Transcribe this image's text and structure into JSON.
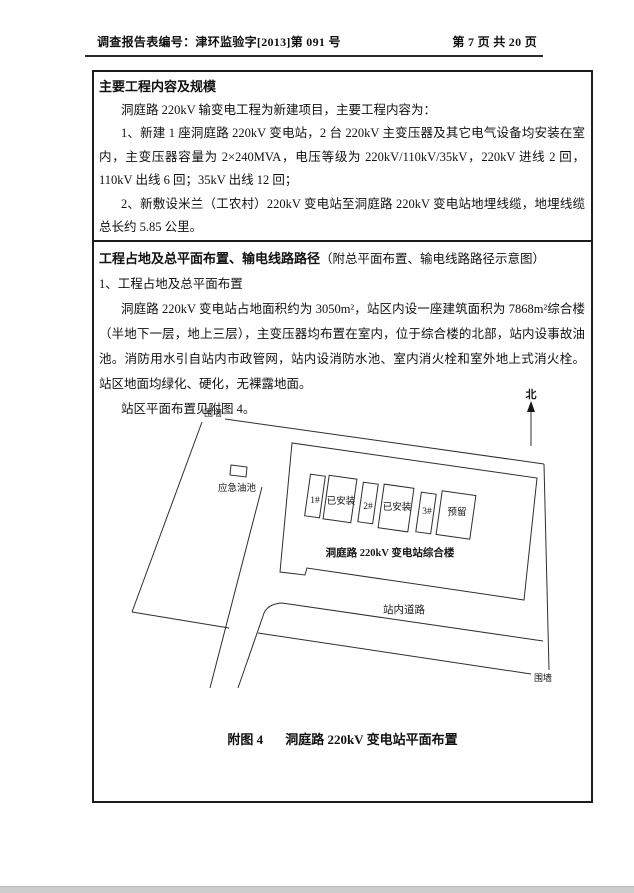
{
  "page_header": {
    "left": "调查报告表编号：津环监验字[2013]第 091 号",
    "right": "第 7 页 共 20 页"
  },
  "section1": {
    "title": "主要工程内容及规模",
    "intro": "洞庭路 220kV 输变电工程为新建项目，主要工程内容为：",
    "item1": "1、新建 1 座洞庭路 220kV 变电站，2 台 220kV 主变压器及其它电气设备均安装在室内，主变压器容量为 2×240MVA，电压等级为 220kV/110kV/35kV，220kV 进线 2 回，110kV 出线 6 回；35kV 出线 12 回；",
    "item2": "2、新敷设米兰（工农村）220kV 变电站至洞庭路 220kV 变电站地埋线缆，地埋线缆总长约 5.85 公里。"
  },
  "section2": {
    "title_bold": "工程占地及总平面布置、输电线路路径",
    "title_note": "（附总平面布置、输电线路路径示意图）",
    "subitem": "1、工程占地及总平面布置",
    "para1": "洞庭路 220kV 变电站占地面积约为 3050m²，站区内设一座建筑面积为 7868m²综合楼（半地下一层，地上三层），主变压器均布置在室内，位于综合楼的北部，站内设事故油池。消防用水引自站内市政管网，站内设消防水池、室内消火栓和室外地上式消火栓。站区地面均绿化、硬化，无裸露地面。",
    "para2": "站区平面布置见附图 4。"
  },
  "diagram": {
    "north_label": "北",
    "fence_label_top": "围墙",
    "fence_label_bottom": "围墙",
    "oil_pool_label": "应急油池",
    "unit1_no": "1#",
    "unit1_status": "已安装",
    "unit2_no": "2#",
    "unit2_status": "已安装",
    "unit3_no": "3#",
    "unit3_status": "预留",
    "building_label": "洞庭路 220kV 变电站综合楼",
    "road_label": "站内道路"
  },
  "figure_caption": {
    "no": "附图 4",
    "text": "洞庭路 220kV 变电站平面布置"
  },
  "colors": {
    "text": "#111111",
    "table_border": "#1c1c1c",
    "bottom_bar": "#cdcdcd"
  }
}
